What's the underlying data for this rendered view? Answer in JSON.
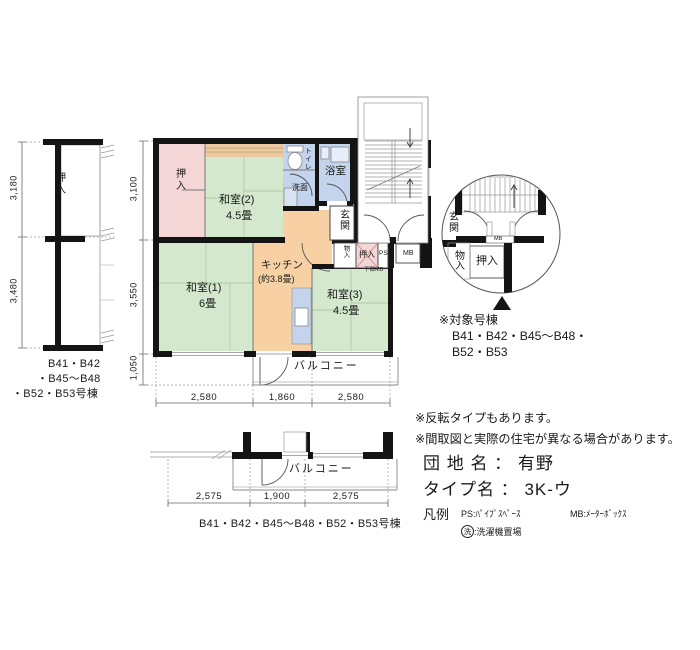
{
  "palette": {
    "tatami_green": "#d3e8cd",
    "closet_pink": "#f5d6d6",
    "water_blue": "#c3d4ec",
    "kitchen_orange": "#f7d1a4",
    "shelf_tan": "#ebc9a0",
    "wall_black": "#141414"
  },
  "left_diagram": {
    "closet": "押入",
    "dim_top": "3,180",
    "dim_bottom": "3,480",
    "building_lines": [
      "B41・B42",
      "・B45〜B48",
      "・B52・B53号棟"
    ]
  },
  "main_plan": {
    "rooms": {
      "oshiire": "押入",
      "washitsu2_name": "和室(2)",
      "washitsu2_size": "4.5畳",
      "toilet": "トイレ",
      "senmen": "洗面",
      "bath": "浴室",
      "genkan": "玄関",
      "monoire": "物入",
      "oshiire2": "押入",
      "ps": "PS",
      "mb": "MB",
      "lower_mb": "下部MB",
      "kitchen_name": "キッチン",
      "kitchen_size": "(約3.8畳)",
      "washitsu1_name": "和室(1)",
      "washitsu1_size": "6畳",
      "washitsu3_name": "和室(3)",
      "washitsu3_size": "4.5畳",
      "balcony": "バルコニー"
    },
    "dims": {
      "left": [
        "3,100",
        "3,550",
        "1,050"
      ],
      "bottom": [
        "2,580",
        "1,860",
        "2,580"
      ]
    }
  },
  "bottom_diagram": {
    "balcony": "バルコニー",
    "dims": [
      "2,575",
      "1,900",
      "2,575"
    ],
    "building_label": "B41・B42・B45〜B48・B52・B53号棟"
  },
  "detail_circle": {
    "genkan": "玄関",
    "mb": "MB",
    "monoire": "物入",
    "oshiire": "押入"
  },
  "target_note": {
    "title": "※対象号棟",
    "line1": "B41・B42・B45〜B48・",
    "line2": "B52・B53"
  },
  "notes": {
    "line1": "※反転タイプもあります。",
    "line2": "※間取図と実際の住宅が異なる場合があります。"
  },
  "info": {
    "danchi_label": "団 地 名 ：",
    "danchi_value": "有野",
    "type_label": "タイプ名 ：",
    "type_value": "3K-ウ"
  },
  "legend": {
    "title": "凡例",
    "ps_item": "PS:ﾊﾟｲﾌﾟｽﾍﾟｰｽ",
    "mb_item": "MB:ﾒｰﾀｰﾎﾞｯｸｽ",
    "laundry_symbol": "洗",
    "laundry_label": ":洗濯機置場"
  }
}
